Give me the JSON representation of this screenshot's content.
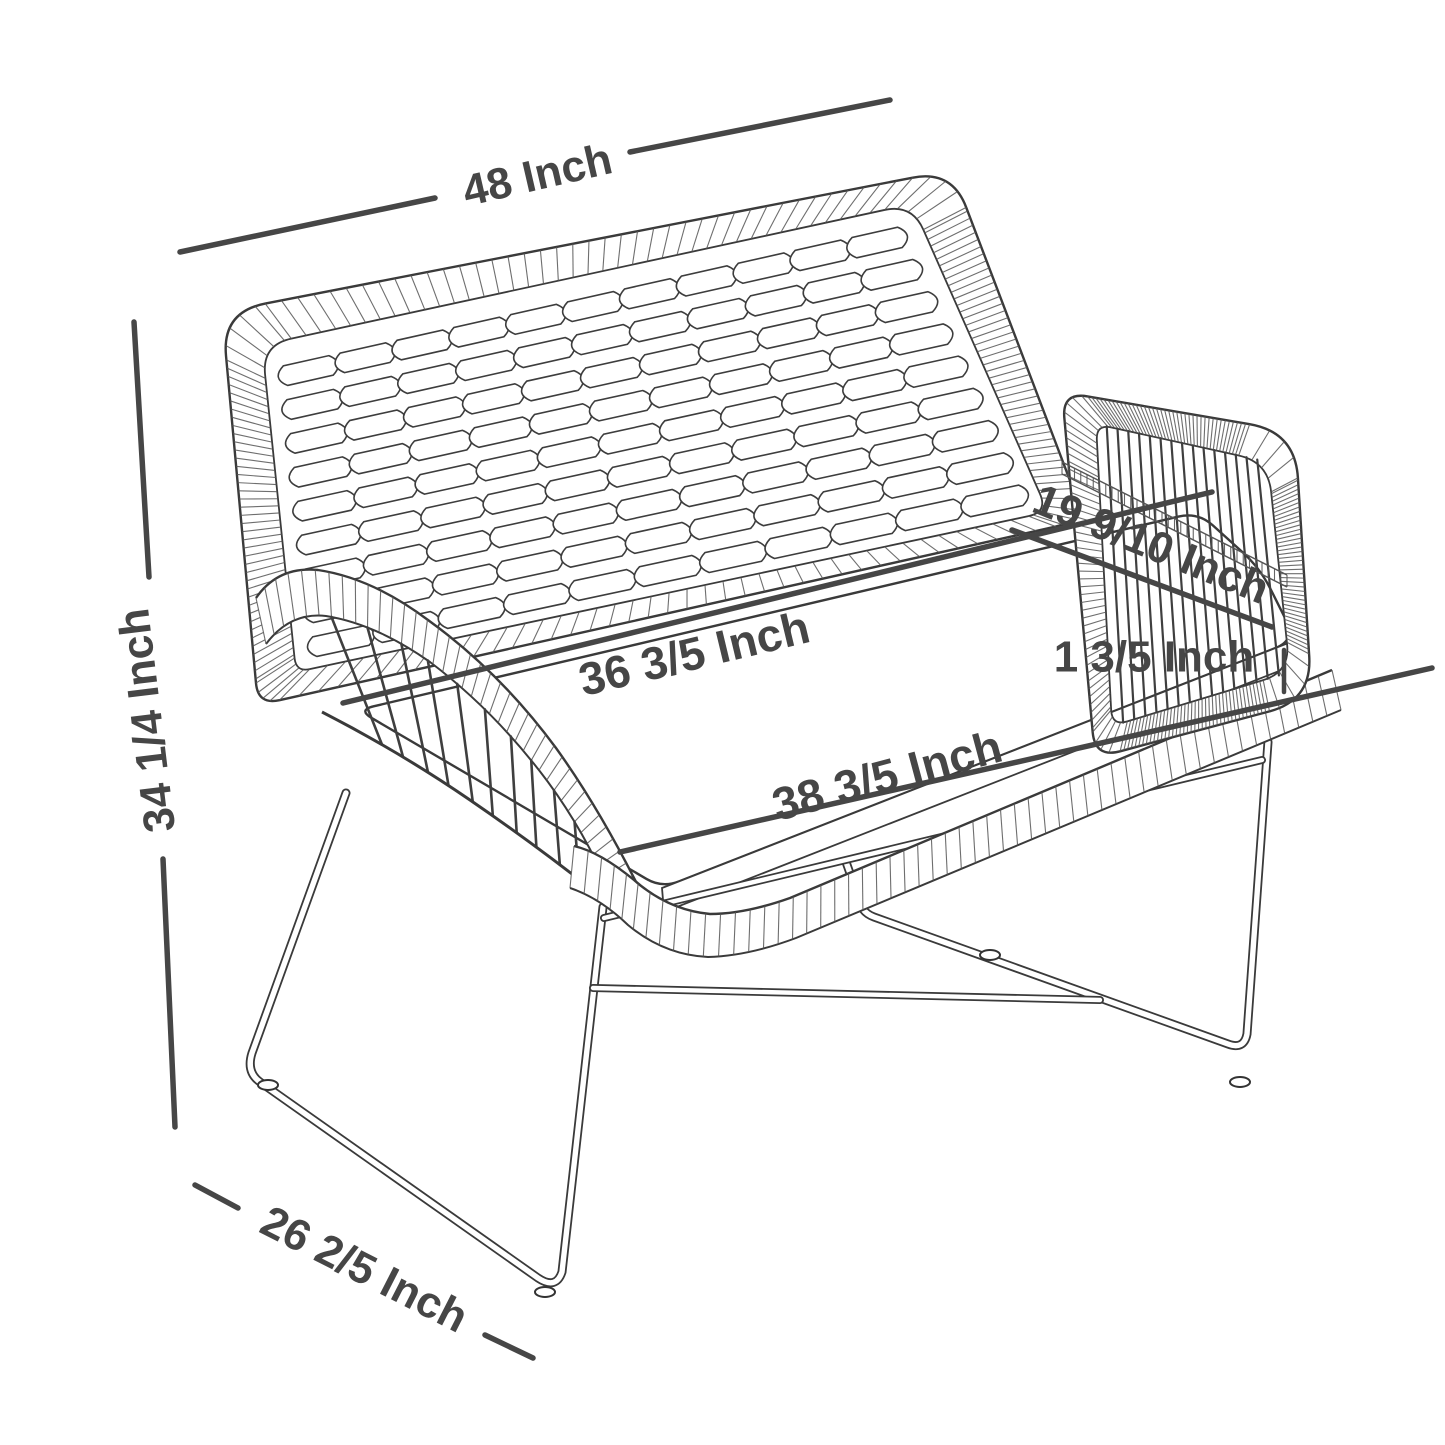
{
  "diagram": {
    "subject": "outdoor wicker loveseat bench with metal sled legs",
    "unit": "Inch",
    "line_color": "#464646",
    "sketch_color": "#3a3a3a"
  },
  "dimensions": {
    "overall_width": {
      "label": "48 Inch",
      "value": 48,
      "measures": "overall width (top, back panel)"
    },
    "overall_height": {
      "label": "34 1/4 Inch",
      "value": 34.25,
      "measures": "overall height (left side)"
    },
    "overall_depth": {
      "label": "26 2/5 Inch",
      "value": 26.4,
      "measures": "overall depth (bottom left, along sled runner)"
    },
    "inner_seat_width": {
      "label": "36 3/5 Inch",
      "value": 36.6,
      "measures": "inner seat width at back of cushion"
    },
    "front_seat_width": {
      "label": "38 3/5 Inch",
      "value": 38.6,
      "measures": "seat width at front edge"
    },
    "seat_depth": {
      "label": "19 9/10 Inch",
      "value": 19.9,
      "measures": "seat depth across right armrest"
    },
    "cushion_thickness": {
      "label": "1 3/5 Inch",
      "value": 1.6,
      "measures": "cushion thickness"
    }
  }
}
